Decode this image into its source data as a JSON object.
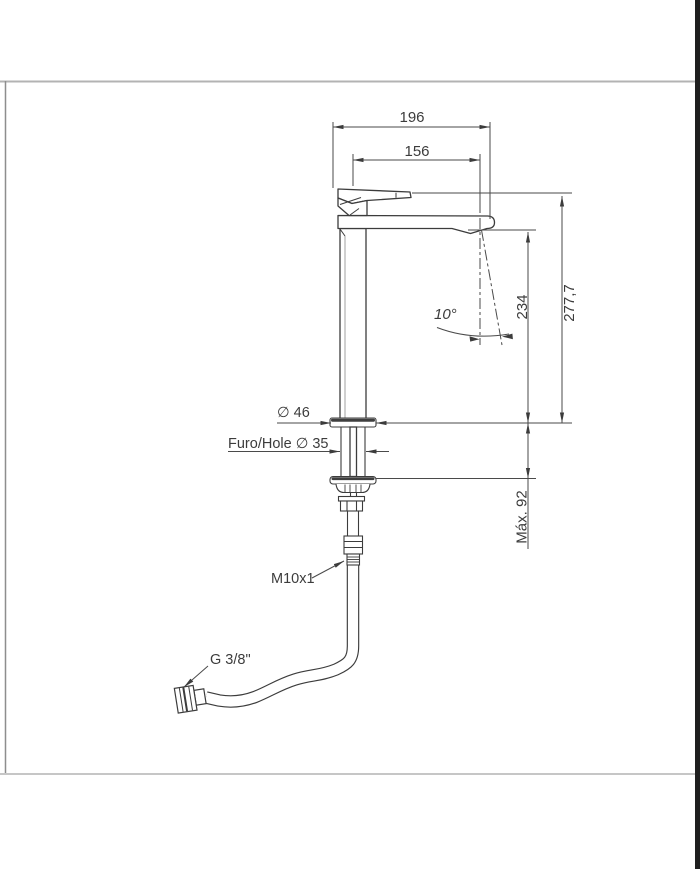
{
  "colors": {
    "background": "#ffffff",
    "line": "#3c3c3c",
    "dimension": "#4a4a4a",
    "frame": "#b3b3b3",
    "edge_bar": "#1f1f1f"
  },
  "drawing": {
    "dimensions": {
      "overall_length": "196",
      "spout_reach": "156",
      "spout_height": "234",
      "total_height": "277,7",
      "swivel_angle": "10°",
      "max_counter_thickness": "Máx. 92"
    },
    "labels": {
      "base_diameter": "∅ 46",
      "mounting_hole": "Furo/Hole ∅ 35",
      "thread_size": "M10x1",
      "supply_connection": "G 3/8\""
    }
  }
}
